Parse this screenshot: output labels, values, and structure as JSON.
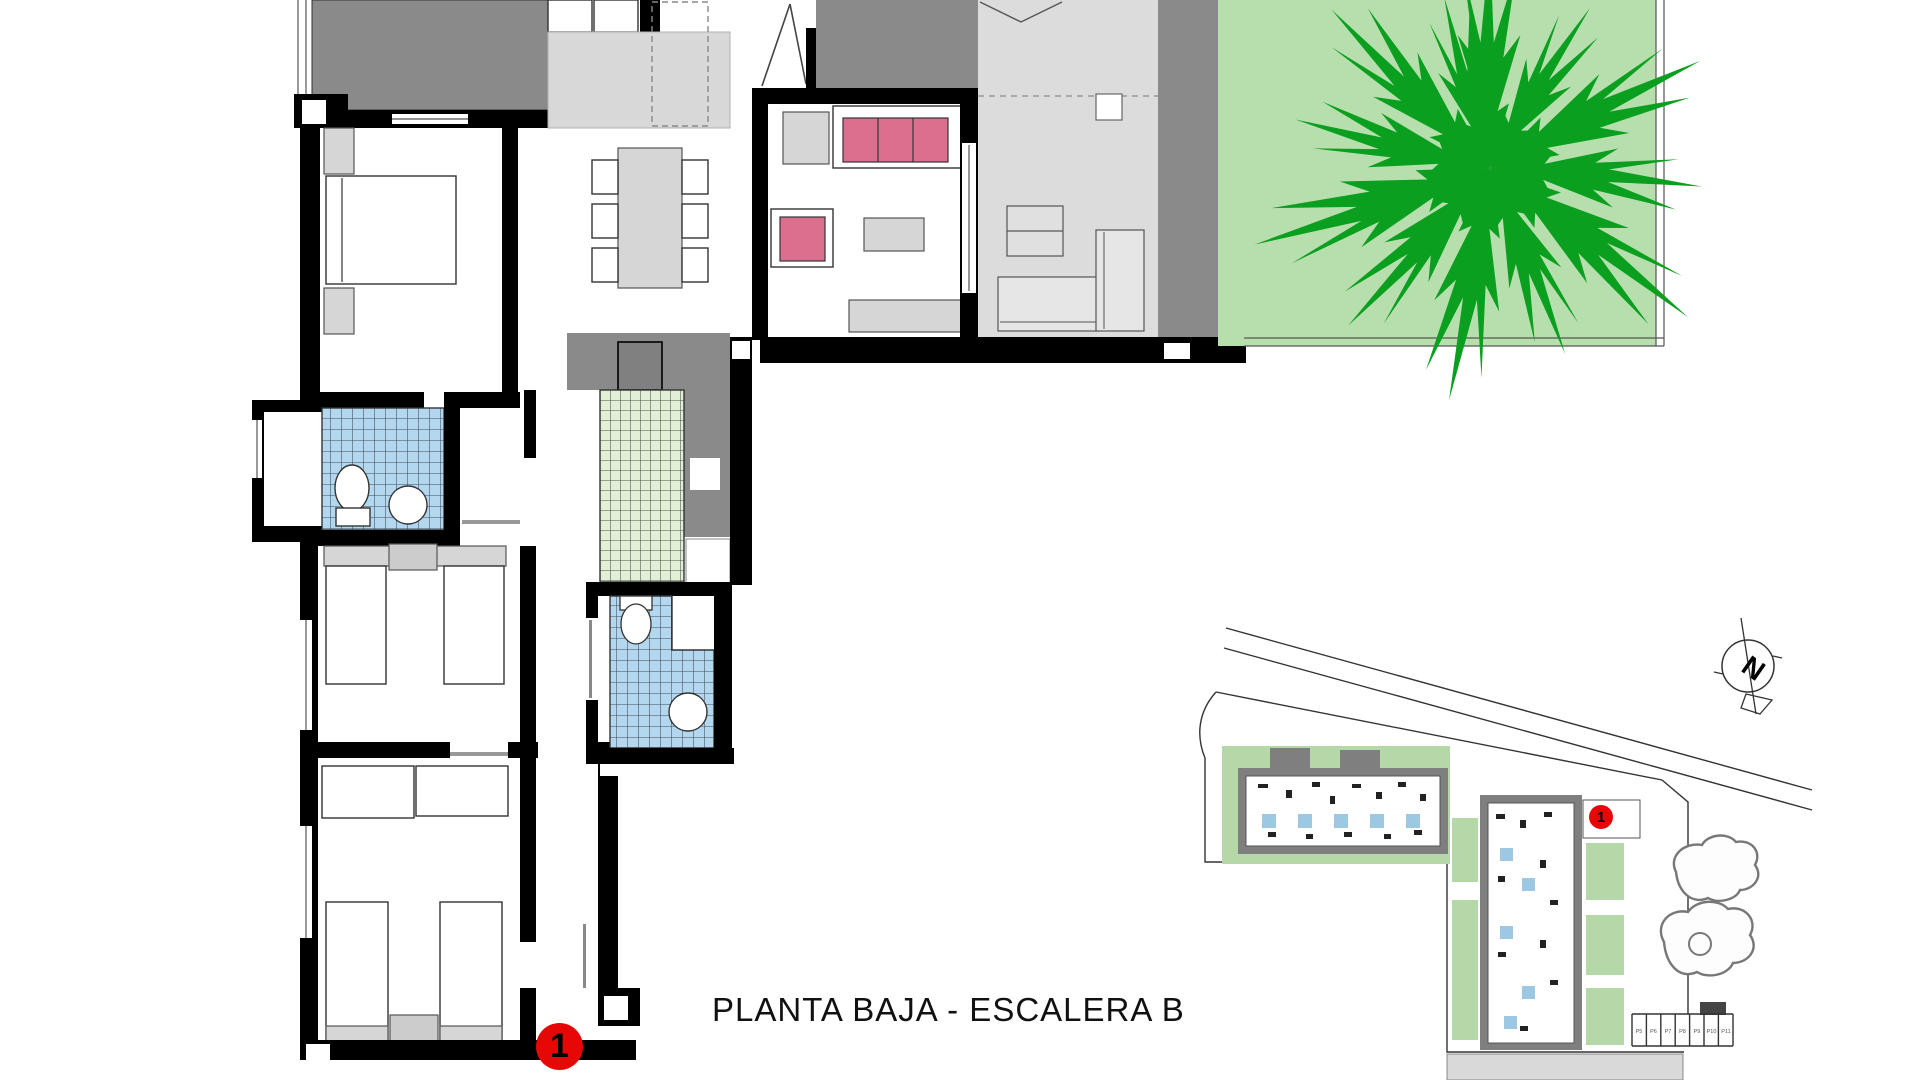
{
  "floor_plan": {
    "title": "PLANTA BAJA - ESCALERA B",
    "unit_marker": "1",
    "colors": {
      "wall_black": "#000000",
      "terrace_dark_grey": "#8a8a8a",
      "floor_light_grey": "#d8d8d8",
      "sofa_pink": "#dd6f8e",
      "bathroom_tile_blue": "#b3d7ee",
      "patio_tile_green": "#e3eed6",
      "garden_green": "#b7dfae",
      "tree_green": "#0a9f1f",
      "marker_red": "#e60707"
    }
  },
  "site_plan": {
    "unit_marker": "1",
    "compass_label": "N",
    "parking_labels": [
      "P5",
      "P6",
      "P7",
      "P8",
      "P9",
      "P10",
      "P11"
    ]
  }
}
